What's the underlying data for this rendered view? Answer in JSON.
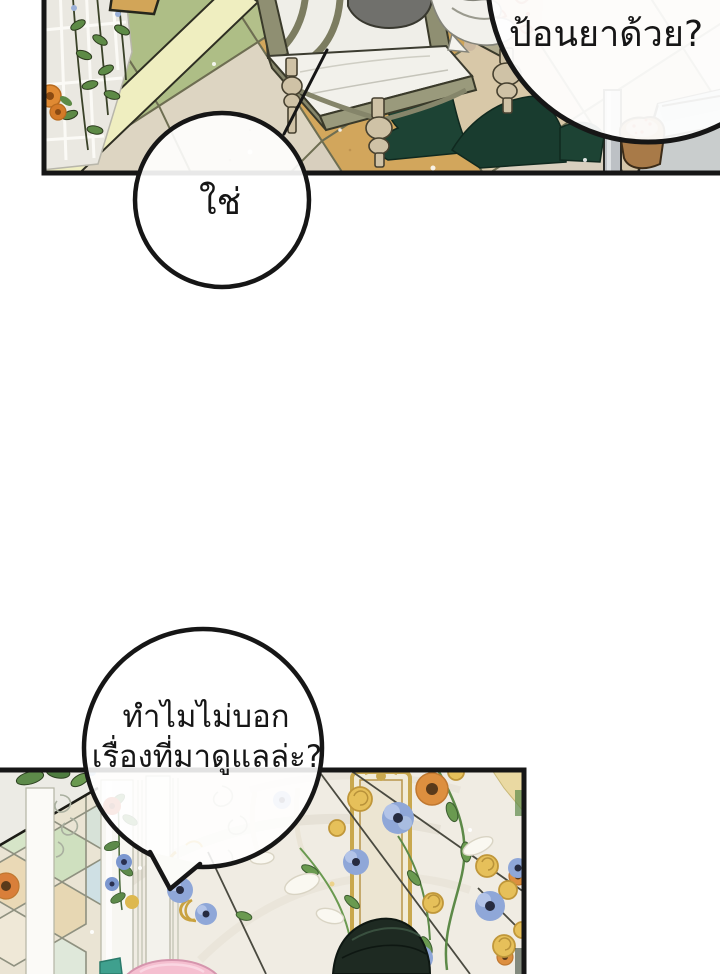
{
  "page": {
    "kind": "comic-page",
    "background": "#ffffff"
  },
  "speech": {
    "feed": {
      "text": "ป้อนยาด้วย?"
    },
    "yes": {
      "text": "ใช่"
    },
    "why": {
      "line1": "ทำไมไม่บอก",
      "line2": "เรื่องที่มาดูแลล่ะ?"
    }
  },
  "colors": {
    "ink": "#161616",
    "bubble_fill": "#ffffff",
    "floor_green": "#aebe86",
    "floor_ochre": "#d3a75c",
    "floor_cream": "#ddd5c2",
    "stripe_yellow": "#efeec0",
    "wood_olive": "#8f8f72",
    "leg_cream": "#cfc2a6",
    "fabric_green": "#1d4334",
    "wallpaper_red": "#b5472a",
    "gold": "#c9a84e",
    "flower_blue": "#8fa7d8",
    "flower_yellow": "#e6c05a",
    "flower_orange": "#dd8f3f",
    "hair_dark": "#1e2a22",
    "pink": "#f5bfd0"
  }
}
